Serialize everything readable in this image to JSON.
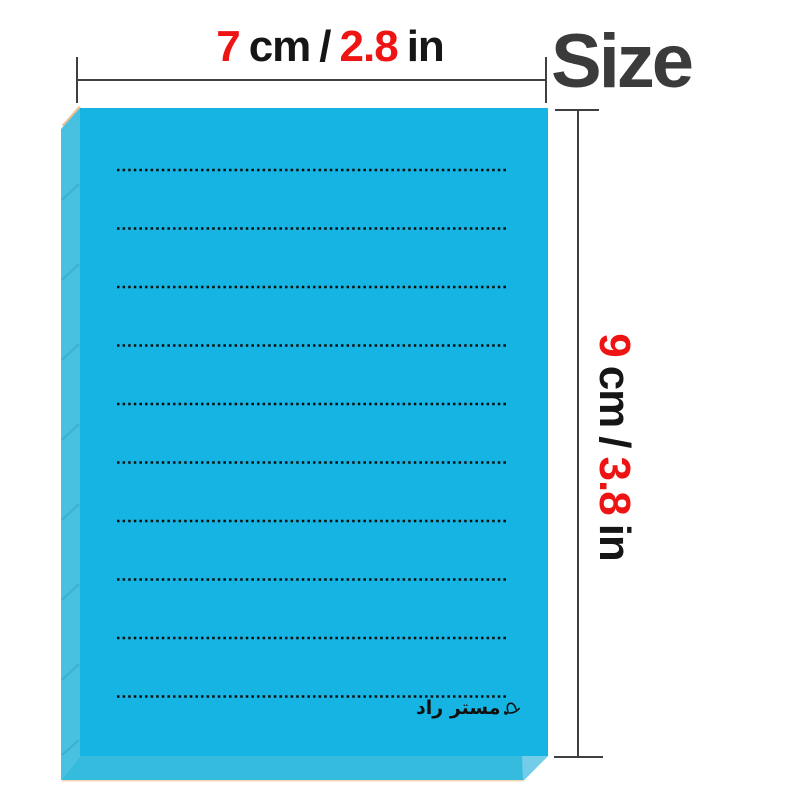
{
  "header": {
    "size_label": "Size"
  },
  "dimensions": {
    "width": {
      "metric_value": "7",
      "metric_unit": "cm",
      "separator": "/",
      "imperial_value": "2.8",
      "imperial_unit": "in"
    },
    "height": {
      "metric_value": "9",
      "metric_unit": "cm",
      "separator": "/",
      "imperial_value": "3.8",
      "imperial_unit": "in"
    }
  },
  "notepad": {
    "brand": "مستر راد",
    "brand_icon": "hat-icon",
    "ruled_line_count": 10,
    "face_color": "#15b4e2",
    "spine_color": "#48c0df",
    "bottom_edge_color": "#35bbde",
    "corner_bevel_color": "#74cde8",
    "backing_paper_color": "#f3d6b2",
    "ruled_line_color": "#0e0e0e"
  },
  "colors": {
    "accent_red": "#ee1414",
    "text_black": "#161616",
    "size_title_gray": "#3b3b3b",
    "dimension_line_gray": "#3f3f3f"
  }
}
